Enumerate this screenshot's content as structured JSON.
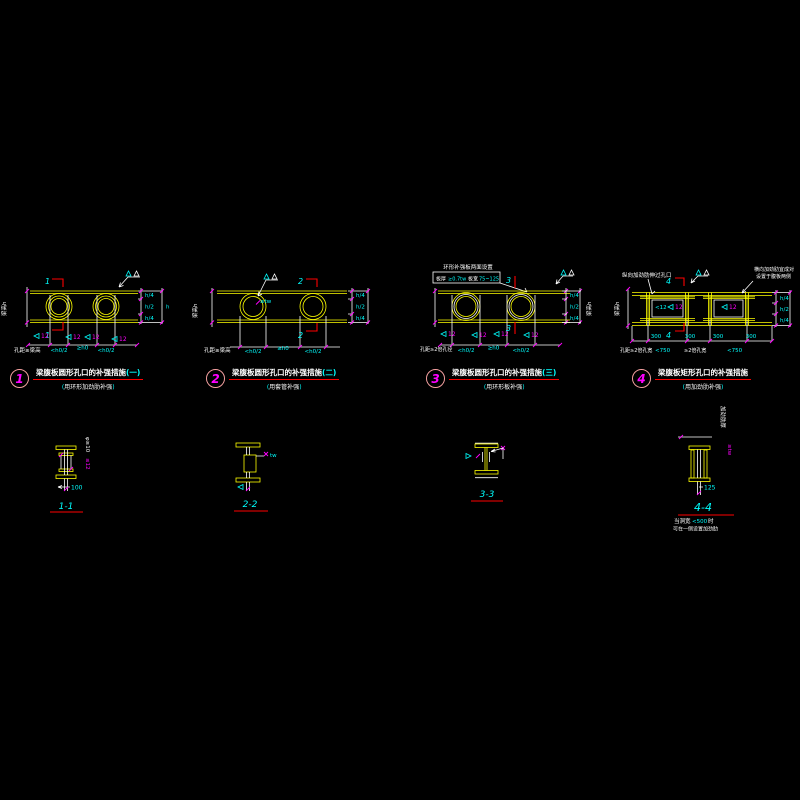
{
  "palette": {
    "bg": "#000000",
    "beam": "#ffff00",
    "line": "#ffffff",
    "tick": "#ff00ff",
    "annotation": "#00ffff",
    "section_cut": "#ff0000",
    "badge_ring": "#f4a0a0",
    "badge_number": "#ff00ff",
    "title_underline": "#ff0000"
  },
  "punct": {
    "open": "(",
    "close": ")"
  },
  "details": [
    {
      "badge": "1",
      "title": "梁腹板圆形孔口的补强措施",
      "suffix": "(一)",
      "subtitle": "用环形加劲肋补强",
      "section": "1",
      "left_label": "梁高h",
      "bottom_note": "孔距≥梁高",
      "welds": [
        "12",
        "12",
        "12",
        "12"
      ],
      "dims_bottom": [
        "<h0/2",
        "≥h0",
        "<h0/2"
      ],
      "dims_right": [
        "h/4",
        "h/2",
        "h/4"
      ],
      "dim_total": "h"
    },
    {
      "badge": "2",
      "title": "梁腹板圆形孔口的补强措施",
      "suffix": "(二)",
      "subtitle": "用套管补强",
      "section": "2",
      "left_label": "梁高h",
      "bottom_note": "孔距≥梁高",
      "sleeve_note": "≥tw",
      "dims_bottom": [
        "<h0/2",
        "≥h0",
        "<h0/2"
      ],
      "dims_right": [
        "h/4",
        "h/2",
        "h/4"
      ]
    },
    {
      "badge": "3",
      "title": "梁腹板圆形孔口的补强措施",
      "suffix": "(三)",
      "subtitle": "用环形板补强",
      "section": "3",
      "box_line1": "环形补强板两面设置",
      "box_parts": [
        "板厚",
        "≥0.7tw",
        "板宽",
        "75~125"
      ],
      "right_label": "梁高h",
      "bottom_note": "孔距≥2倍孔径",
      "welds": [
        "12",
        "12",
        "12",
        "12"
      ],
      "dims_bottom": [
        "<h0/2",
        "≥h0",
        "<h0/2"
      ],
      "dims_right": [
        "h/4",
        "h/2",
        "h/4"
      ]
    },
    {
      "badge": "4",
      "title": "梁腹板矩形孔口的补强措施",
      "suffix": "",
      "subtitle": "用加劲肋补强",
      "section": "4",
      "note_tl": "纵向加劲肋伸过孔口",
      "note_tr1": "横向加劲肋宜成对",
      "note_tr2": "设置于腹板两侧",
      "left_label": "梁高h",
      "bottom_note": "孔距≥2倍孔宽",
      "inner_dims": [
        "<12",
        "12",
        "12"
      ],
      "dims_300": [
        "300",
        "300",
        "300",
        "300"
      ],
      "dims_bottom": [
        "<750",
        "≥2倍孔宽",
        "<750"
      ],
      "dims_right": [
        "h/4",
        "h/2",
        "h/4"
      ]
    }
  ],
  "sections": [
    {
      "label": "1-1",
      "dim": "100",
      "side_a": "φ≥10",
      "side_b": "≤12"
    },
    {
      "label": "2-2",
      "side_a": "tw"
    },
    {
      "label": "3-3"
    },
    {
      "label": "4-4",
      "dim": "125",
      "side_a": "加劲肋厚",
      "side_b": "≥tw",
      "note1a": "当洞宽",
      "note1b": "<500",
      "note1c": "时",
      "note2": "可在一侧设置加劲肋"
    }
  ]
}
